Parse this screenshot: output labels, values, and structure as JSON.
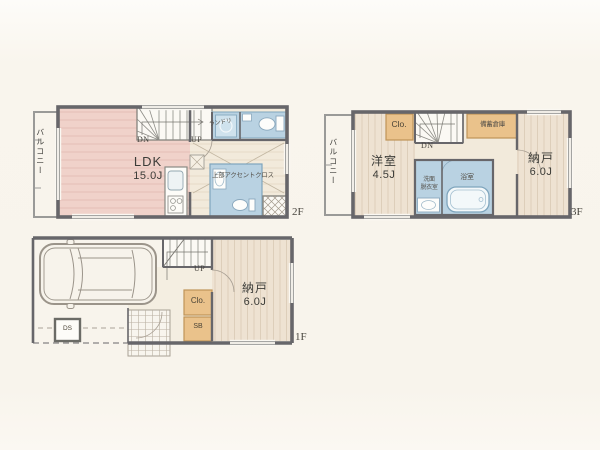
{
  "floor2": {
    "balcony": "バルコニー",
    "ldk": "LDK",
    "ldk_size": "15.0J",
    "dn": "DN",
    "up": "UP",
    "laundry": "ランドリ",
    "accent_note": "上部アクセントクロス",
    "tag": "2F"
  },
  "floor3": {
    "balcony": "バルコニー",
    "closet": "Clo.",
    "dn": "DN",
    "stock_storage": "備蓄倉庫",
    "room": "洋室",
    "room_size": "4.5J",
    "nando": "納戸",
    "nando_size": "6.0J",
    "wash_line1": "洗面",
    "wash_line2": "脱衣室",
    "bath": "浴室",
    "tag": "3F"
  },
  "floor1": {
    "up": "UP",
    "nando": "納戸",
    "nando_size": "6.0J",
    "closet": "Clo.",
    "shoe_box": "SB",
    "duct_space": "DS",
    "tag": "1F"
  },
  "colors": {
    "background": "#f8f4ec",
    "wall": "#67666a",
    "pink_floor": "#f0d2ca",
    "wood_floor": "#eee2d2",
    "hall_floor": "#f2eadb",
    "wet_area": "#b9d2e2",
    "closet_fill": "#eac28b",
    "text": "#3c3c38"
  }
}
